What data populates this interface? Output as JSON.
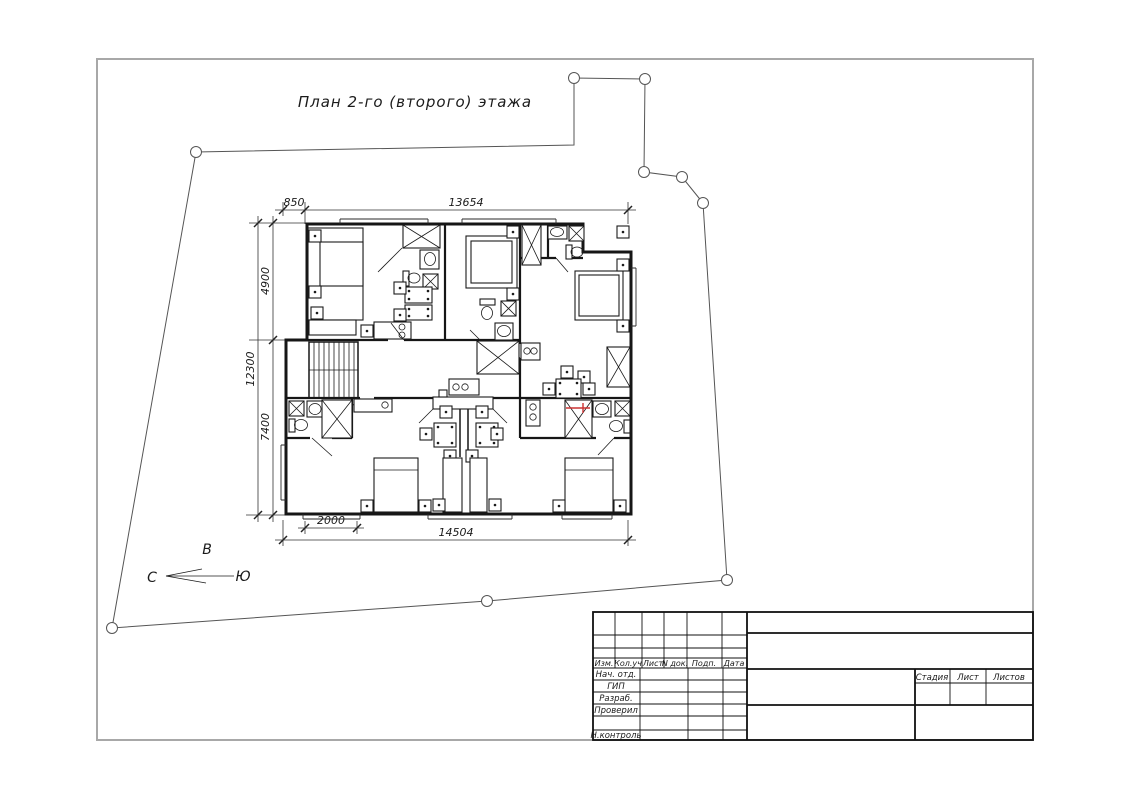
{
  "drawing": {
    "title": "План 2-го (второго) этажа",
    "type": "floor-plan-blueprint"
  },
  "compass": {
    "east": "В",
    "north": "С",
    "south": "Ю"
  },
  "dimensions": {
    "top_offset": "850",
    "top_width": "13654",
    "left_upper": "4900",
    "left_total": "12300",
    "left_lower": "7400",
    "bottom_offset": "2000",
    "bottom_width": "14504"
  },
  "title_block": {
    "revision_columns": [
      "Изм.",
      "Кол.уч",
      "Лист",
      "N док.",
      "Подп.",
      "Дата"
    ],
    "signature_rows": [
      "Нач. отд.",
      "ГИП",
      "Разраб.",
      "Проверил",
      "Н.контроль"
    ],
    "sheet_columns": [
      "Стадия",
      "Лист",
      "Листов"
    ]
  },
  "colors": {
    "ink": "#1b1b1b",
    "frame_gray": "#a8a8a8",
    "marker_red": "#cc3333"
  }
}
